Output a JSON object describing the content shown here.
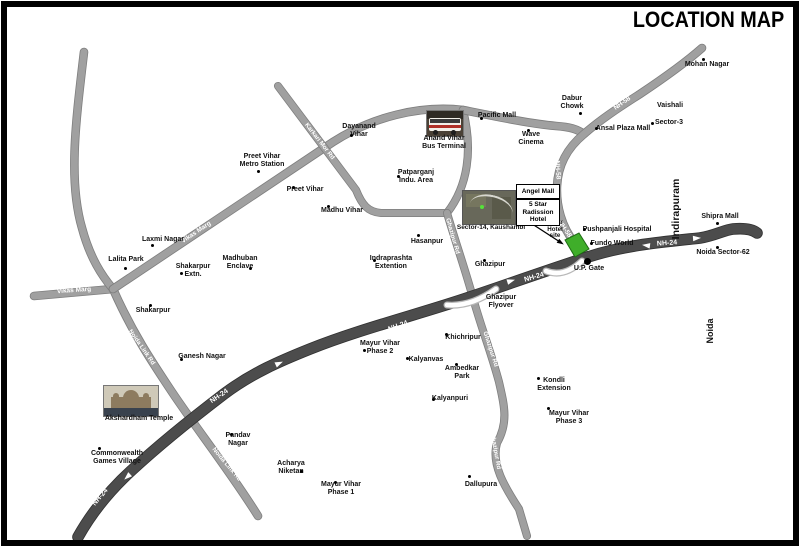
{
  "title": "LOCATION MAP",
  "colors": {
    "road": "#a0a0a0",
    "road_edge": "#7e7e7e",
    "highway": "#4c4c4c",
    "highway_edge": "#303030",
    "site_green": "#3fae2a",
    "site_green_edge": "#1e6b14",
    "label": "#111111",
    "road_text": "#ffffff"
  },
  "roads": [
    {
      "id": "vikas-marg-horizontal",
      "d": "M34,296 L113,289",
      "w": 7,
      "dark": false
    },
    {
      "id": "left-road",
      "d": "M84,52 C76,120 68,180 82,228 C90,258 102,276 113,289",
      "w": 7,
      "dark": false
    },
    {
      "id": "noida-link-rd",
      "d": "M113,289 C132,332 152,362 172,392 C196,428 232,474 258,516",
      "w": 7,
      "dark": false
    },
    {
      "id": "vikas-marg-diagonal",
      "d": "M113,289 L333,142 C372,117 420,105 463,110",
      "w": 7,
      "dark": false
    },
    {
      "id": "anand-vihar-link",
      "d": "M463,110 C473,150 468,186 447,213",
      "w": 6.5,
      "dark": false
    },
    {
      "id": "karkari-mor-rd",
      "d": "M278,86 L356,190 C362,205 368,212 381,213 L447,213",
      "w": 6.5,
      "dark": false
    },
    {
      "id": "ghazipur-rd",
      "d": "M447,213 C458,250 466,272 473,298 C481,327 491,352 499,382 C504,404 509,422 497,443 C491,464 504,486 519,509 L527,536",
      "w": 6.5,
      "dark": false
    },
    {
      "id": "pacific-mall-rd",
      "d": "M463,110 C498,117 532,124 556,126 C570,127 577,129 584,134",
      "w": 7,
      "dark": false
    },
    {
      "id": "nh-58",
      "d": "M702,48 C684,64 658,82 640,94 C618,108 600,120 584,134 C566,149 558,166 557,186 C556,206 562,227 574,242 C579,249 583,253 588,257",
      "w": 7,
      "dark": false
    },
    {
      "id": "nh-24",
      "d": "M78,537 C92,512 110,490 132,470 C160,444 190,420 224,394 C252,373 280,361 310,349 C360,329 420,314 470,297 C500,287 545,271 588,257 C625,245 662,242 700,238 C714,236 724,230 733,229 C744,228 752,229 757,233",
      "w": 10,
      "dark": true
    }
  ],
  "flyovers": [
    {
      "id": "ghazipur-flyover-ramp",
      "d": "M447,305 Q471,307 496,289"
    },
    {
      "id": "up-gate-flyover-ramp",
      "d": "M546,271 Q564,278 582,261"
    }
  ],
  "road_labels": [
    {
      "id": "nh24-1",
      "text": "NH-24",
      "x": 100,
      "y": 497,
      "a": -50,
      "fs": 7
    },
    {
      "id": "nh24-2",
      "text": "NH-24",
      "x": 219,
      "y": 396,
      "a": -34,
      "fs": 7
    },
    {
      "id": "nh24-3",
      "text": "NH-24",
      "x": 398,
      "y": 326,
      "a": -20,
      "fs": 7
    },
    {
      "id": "nh24-4",
      "text": "NH-24",
      "x": 534,
      "y": 277,
      "a": -16,
      "fs": 7
    },
    {
      "id": "nh24-5",
      "text": "NH-24",
      "x": 667,
      "y": 243,
      "a": -4,
      "fs": 7
    },
    {
      "id": "nh58-1",
      "text": "NH-58",
      "x": 622,
      "y": 103,
      "a": -35,
      "fs": 6.5
    },
    {
      "id": "nh58-2",
      "text": "NH-58",
      "x": 558,
      "y": 170,
      "a": 86,
      "fs": 6.5
    },
    {
      "id": "nh58-3",
      "text": "NH-58",
      "x": 565,
      "y": 229,
      "a": 55,
      "fs": 6.5
    },
    {
      "id": "vikas-marg-1",
      "text": "Vikas Marg",
      "x": 74,
      "y": 290,
      "a": -4,
      "fs": 6.5
    },
    {
      "id": "vikas-marg-2",
      "text": "Vikas Marg",
      "x": 196,
      "y": 232,
      "a": -34,
      "fs": 6.5
    },
    {
      "id": "noida-link-1",
      "text": "Noida Link Rd",
      "x": 142,
      "y": 347,
      "a": 55,
      "fs": 6.2
    },
    {
      "id": "noida-link-2",
      "text": "Noida Link Rd",
      "x": 227,
      "y": 464,
      "a": 50,
      "fs": 6.2
    },
    {
      "id": "karkari",
      "text": "Karkari Mor Rd",
      "x": 320,
      "y": 141,
      "a": 52,
      "fs": 6.2
    },
    {
      "id": "ghazipur-rd-1",
      "text": "Ghazipur Rd",
      "x": 453,
      "y": 236,
      "a": 74,
      "fs": 6.2
    },
    {
      "id": "ghazipur-rd-2",
      "text": "Ghazipur Rd",
      "x": 491,
      "y": 349,
      "a": 72,
      "fs": 6.2
    },
    {
      "id": "ghazipur-rd-3",
      "text": "Ghazipur Rd",
      "x": 496,
      "y": 451,
      "a": 80,
      "fs": 6.2
    }
  ],
  "highway_arrows": [
    {
      "x": 125,
      "y": 479,
      "a": 137
    },
    {
      "x": 282,
      "y": 362,
      "a": -25
    },
    {
      "x": 514,
      "y": 280,
      "a": -17
    },
    {
      "x": 643,
      "y": 245,
      "a": 187
    },
    {
      "x": 700,
      "y": 238,
      "a": -4
    }
  ],
  "site": {
    "label": "5-star-hotel-site",
    "points": "565,240 579,233 589,249 575,257"
  },
  "site_arrow": {
    "x1": 523,
    "y1": 218,
    "x2": 560,
    "y2": 242,
    "a": 33
  },
  "up_gate_dot": {
    "x": 587,
    "y": 261,
    "size": 7
  },
  "callout_boxes": [
    {
      "id": "angel-mall",
      "x": 516,
      "y": 184,
      "w": 42,
      "h": 13,
      "lines": [
        "Angel Mall"
      ]
    },
    {
      "id": "radission-hotel",
      "x": 516,
      "y": 199,
      "w": 42,
      "h": 25,
      "lines": [
        "5 Star",
        "Radission",
        "Hotel"
      ]
    }
  ],
  "vertical_labels": [
    {
      "id": "indirapuram",
      "text": "Indirapuram",
      "x": 676,
      "y": 209,
      "fs": 10.5
    },
    {
      "id": "noida",
      "text": "Noida",
      "x": 710,
      "y": 331,
      "fs": 9
    }
  ],
  "places": [
    {
      "id": "mohan-nagar",
      "lines": [
        "Mohan Nagar"
      ],
      "x": 707,
      "y": 65,
      "dot": [
        703,
        59
      ]
    },
    {
      "id": "vaishali",
      "lines": [
        "Vaishali"
      ],
      "x": 670,
      "y": 106
    },
    {
      "id": "sector-3",
      "lines": [
        "Sector-3"
      ],
      "x": 669,
      "y": 123,
      "dot": [
        652,
        123
      ]
    },
    {
      "id": "ansal-plaza-mall",
      "lines": [
        "Ansal Plaza Mall"
      ],
      "x": 623,
      "y": 129,
      "dot": [
        596,
        128
      ]
    },
    {
      "id": "dabur-chowk",
      "lines": [
        "Dabur",
        "Chowk"
      ],
      "x": 572,
      "y": 103,
      "dot": [
        580,
        113
      ]
    },
    {
      "id": "pacific-mall",
      "lines": [
        "Pacific Mall"
      ],
      "x": 497,
      "y": 116,
      "dot": [
        481,
        118
      ]
    },
    {
      "id": "wave-cinema",
      "lines": [
        "Wave",
        "Cinema"
      ],
      "x": 531,
      "y": 139,
      "dot": [
        528,
        130
      ]
    },
    {
      "id": "anand-vihar-bus-terminal",
      "lines": [
        "Anand Vihar",
        "Bus Terminal"
      ],
      "x": 444,
      "y": 143
    },
    {
      "id": "dayanand-vihar",
      "lines": [
        "Dayanand",
        "Vihar"
      ],
      "x": 359,
      "y": 131,
      "dot": [
        351,
        135
      ]
    },
    {
      "id": "preet-vihar-metro-station",
      "lines": [
        "Preet Vihar",
        "Metro Station"
      ],
      "x": 262,
      "y": 161,
      "dot": [
        258,
        171
      ]
    },
    {
      "id": "preet-vihar",
      "lines": [
        "Preet Vihar"
      ],
      "x": 305,
      "y": 190,
      "dot": [
        293,
        187
      ]
    },
    {
      "id": "madhu-vihar",
      "lines": [
        "Madhu Vihar"
      ],
      "x": 342,
      "y": 211,
      "dot": [
        328,
        206
      ]
    },
    {
      "id": "patparganj-indu-area",
      "lines": [
        "Patparganj",
        "Indu. Area"
      ],
      "x": 416,
      "y": 177,
      "dot": [
        398,
        176
      ]
    },
    {
      "id": "hasanpur",
      "lines": [
        "Hasanpur"
      ],
      "x": 427,
      "y": 242,
      "dot": [
        418,
        235
      ]
    },
    {
      "id": "indraprashta-extention",
      "lines": [
        "Indraprashta",
        "Extention"
      ],
      "x": 391,
      "y": 263,
      "dot": [
        374,
        260
      ]
    },
    {
      "id": "laxmi-nagar",
      "lines": [
        "Laxmi Nagar"
      ],
      "x": 163,
      "y": 240,
      "dot": [
        152,
        245
      ]
    },
    {
      "id": "lalita-park",
      "lines": [
        "Lalita Park"
      ],
      "x": 126,
      "y": 260,
      "dot": [
        125,
        268
      ]
    },
    {
      "id": "shakarpur-extn",
      "lines": [
        "Shakarpur",
        "Extn."
      ],
      "x": 193,
      "y": 271,
      "dot": [
        181,
        273
      ]
    },
    {
      "id": "madhuban-enclave",
      "lines": [
        "Madhuban",
        "Enclave"
      ],
      "x": 240,
      "y": 263,
      "dot": [
        250,
        268
      ]
    },
    {
      "id": "shakarpur",
      "lines": [
        "Shakarpur"
      ],
      "x": 153,
      "y": 311,
      "dot": [
        150,
        305
      ]
    },
    {
      "id": "ganesh-nagar",
      "lines": [
        "Ganesh Nagar"
      ],
      "x": 202,
      "y": 357,
      "dot": [
        181,
        359
      ]
    },
    {
      "id": "ghazipur",
      "lines": [
        "Ghazipur"
      ],
      "x": 490,
      "y": 265,
      "dot": [
        484,
        260
      ]
    },
    {
      "id": "ghazipur-flyover",
      "lines": [
        "Ghazipur",
        "Flyover"
      ],
      "x": 501,
      "y": 302
    },
    {
      "id": "mayur-vihar-phase-2",
      "lines": [
        "Mayur Vihar",
        "Phase 2"
      ],
      "x": 380,
      "y": 348,
      "dot": [
        364,
        350
      ]
    },
    {
      "id": "khichripur",
      "lines": [
        "Khichripur"
      ],
      "x": 463,
      "y": 338,
      "dot": [
        446,
        334
      ]
    },
    {
      "id": "kalyanvas",
      "lines": [
        "Kalyanvas"
      ],
      "x": 426,
      "y": 360,
      "dot": [
        407,
        358
      ]
    },
    {
      "id": "ambedkar-park",
      "lines": [
        "Ambedkar",
        "Park"
      ],
      "x": 462,
      "y": 373,
      "dot": [
        456,
        364
      ]
    },
    {
      "id": "kalyanpuri",
      "lines": [
        "Kalyanpuri"
      ],
      "x": 450,
      "y": 399,
      "dot": [
        433,
        399
      ]
    },
    {
      "id": "pandav-nagar",
      "lines": [
        "Pandav",
        "Nagar"
      ],
      "x": 238,
      "y": 440,
      "dot": [
        231,
        434
      ]
    },
    {
      "id": "acharya-niketan",
      "lines": [
        "Acharya",
        "Niketan"
      ],
      "x": 291,
      "y": 468,
      "dot": [
        301,
        471
      ]
    },
    {
      "id": "mayur-vihar-phase-1",
      "lines": [
        "Mayur Vihar",
        "Phase 1"
      ],
      "x": 341,
      "y": 489,
      "dot": [
        335,
        482
      ]
    },
    {
      "id": "dallupura",
      "lines": [
        "Dallupura"
      ],
      "x": 481,
      "y": 485,
      "dot": [
        469,
        476
      ]
    },
    {
      "id": "kondli-extension",
      "lines": [
        "Kondli",
        "Extension"
      ],
      "x": 554,
      "y": 385,
      "dot": [
        538,
        378
      ]
    },
    {
      "id": "mayur-vihar-phase-3",
      "lines": [
        "Mayur Vihar",
        "Phase 3"
      ],
      "x": 569,
      "y": 418,
      "dot": [
        548,
        408
      ]
    },
    {
      "id": "commonwealth-games-village",
      "lines": [
        "Commonwealth",
        "Games Village"
      ],
      "x": 117,
      "y": 458,
      "dot": [
        99,
        448
      ]
    },
    {
      "id": "akshardham-temple",
      "lines": [
        "Akshardham Temple"
      ],
      "x": 139,
      "y": 419
    },
    {
      "id": "pushpanjali-hospital",
      "lines": [
        "Pushpanjali Hospital"
      ],
      "x": 617,
      "y": 230,
      "dot": [
        584,
        229
      ]
    },
    {
      "id": "fundo-world",
      "lines": [
        "Fundo World"
      ],
      "x": 612,
      "y": 244,
      "dot": [
        591,
        243
      ]
    },
    {
      "id": "up-gate",
      "lines": [
        "U.P. Gate"
      ],
      "x": 589,
      "y": 269
    },
    {
      "id": "shipra-mall",
      "lines": [
        "Shipra Mall"
      ],
      "x": 720,
      "y": 217,
      "dot": [
        717,
        223
      ]
    },
    {
      "id": "noida-sector-62",
      "lines": [
        "Noida Sector-62"
      ],
      "x": 723,
      "y": 253,
      "dot": [
        717,
        247
      ]
    },
    {
      "id": "sector-14-kaushambi",
      "lines": [
        "Sector-14, Kaushambi"
      ],
      "x": 491,
      "y": 228,
      "fs": 6.5
    },
    {
      "id": "five-star-hotel-site",
      "lines": [
        "5Star",
        "Hotel",
        "site"
      ],
      "x": 555,
      "y": 230,
      "fs": 6.2
    }
  ]
}
